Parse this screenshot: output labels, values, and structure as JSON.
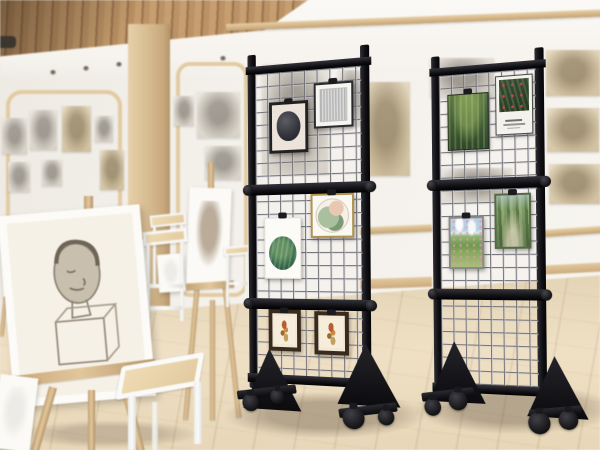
{
  "colors": {
    "stand_frame": "#17171b",
    "grid_wire": "#8f8f96",
    "wall": "#f4f1ec",
    "wood_trim": "#d8bd92",
    "ceiling_slats": "#c29a6b",
    "floor": "#e9dabd",
    "easel_wood": "#d9be94",
    "canvas_white": "#fbfaf6",
    "wheel_black": "#141416"
  },
  "stands": {
    "left": {
      "label": "rolling-grid-panel-display-stand",
      "sections": 3,
      "wheel_count": 4,
      "artworks": [
        {
          "name": "charcoal-circle-framed-print",
          "kind": "dark-circle",
          "x": 25,
          "y": 56,
          "w": 41,
          "h": 52,
          "bw": 3,
          "frame": "#232021",
          "mat": "#ece4da"
        },
        {
          "name": "gray-stripe-framed-print",
          "kind": "stripes",
          "x": 72,
          "y": 40,
          "w": 40,
          "h": 45,
          "bw": 2,
          "frame": "#2b2b2d",
          "mat": "#f6f5f2"
        },
        {
          "name": "succulent-art-print",
          "kind": "succulent",
          "x": 19,
          "y": 173,
          "w": 39,
          "h": 62,
          "bw": 1,
          "frame": "#e4e1da",
          "mat": "#fcfbf7"
        },
        {
          "name": "abstract-circle-gold-framed-print",
          "kind": "abstract-circle",
          "x": 68,
          "y": 150,
          "w": 44,
          "h": 44,
          "bw": 2,
          "frame": "#b3914e",
          "mat": "#faf8f3"
        },
        {
          "name": "botanical-bird-print-1",
          "kind": "bird",
          "x": 23,
          "y": 266,
          "w": 34,
          "h": 42,
          "bw": 4,
          "frame": "#392a1e",
          "mat": "#f2e8d4"
        },
        {
          "name": "botanical-bird-print-2",
          "kind": "bird",
          "x": 71,
          "y": 267,
          "w": 35,
          "h": 43,
          "bw": 4,
          "frame": "#392a1e",
          "mat": "#f2e8d4"
        }
      ]
    },
    "right": {
      "label": "rolling-grid-panel-display-stand",
      "sections": 3,
      "wheel_count": 4,
      "artworks": [
        {
          "name": "forest-painting",
          "kind": "forest",
          "x": 19,
          "y": 46,
          "w": 43,
          "h": 57,
          "bw": 1,
          "frame": "#26301f",
          "mat": "#44603a"
        },
        {
          "name": "botanical-poster",
          "kind": "poster",
          "x": 69,
          "y": 31,
          "w": 38,
          "h": 59,
          "bw": 1,
          "frame": "#4a4a48",
          "mat": "#f4f2ec"
        },
        {
          "name": "meadow-landscape-painting",
          "kind": "meadow",
          "x": 19,
          "y": 170,
          "w": 37,
          "h": 53,
          "bw": 2,
          "frame": "#8a8a86",
          "mat": "#bcd3e2"
        },
        {
          "name": "tree-path-painting",
          "kind": "trees",
          "x": 67,
          "y": 148,
          "w": 37,
          "h": 55,
          "bw": 2,
          "frame": "#55684a",
          "mat": "#7e9a64"
        }
      ]
    }
  },
  "wall_sketches": [
    {
      "x": 2,
      "y": 118,
      "w": 25,
      "h": 36,
      "tone": "gray"
    },
    {
      "x": 30,
      "y": 110,
      "w": 27,
      "h": 40,
      "tone": "gray"
    },
    {
      "x": 62,
      "y": 106,
      "w": 29,
      "h": 46,
      "tone": "sepia"
    },
    {
      "x": 95,
      "y": 116,
      "w": 18,
      "h": 26,
      "tone": "gray"
    },
    {
      "x": 8,
      "y": 162,
      "w": 22,
      "h": 30,
      "tone": "gray"
    },
    {
      "x": 42,
      "y": 160,
      "w": 20,
      "h": 26,
      "tone": "gray"
    },
    {
      "x": 100,
      "y": 150,
      "w": 24,
      "h": 40,
      "tone": "sepia"
    },
    {
      "x": 174,
      "y": 96,
      "w": 20,
      "h": 30,
      "tone": "gray"
    },
    {
      "x": 197,
      "y": 92,
      "w": 43,
      "h": 46,
      "tone": "gray"
    },
    {
      "x": 205,
      "y": 146,
      "w": 36,
      "h": 34,
      "tone": "gray"
    },
    {
      "x": 262,
      "y": 64,
      "w": 66,
      "h": 110,
      "tone": "gray"
    },
    {
      "x": 338,
      "y": 70,
      "w": 26,
      "h": 56,
      "tone": "gray"
    },
    {
      "x": 362,
      "y": 82,
      "w": 48,
      "h": 94,
      "tone": "sepia"
    },
    {
      "x": 430,
      "y": 58,
      "w": 64,
      "h": 40,
      "tone": "gray"
    },
    {
      "x": 440,
      "y": 168,
      "w": 72,
      "h": 34,
      "tone": "gray"
    },
    {
      "x": 546,
      "y": 50,
      "w": 54,
      "h": 46,
      "tone": "sepia"
    },
    {
      "x": 547,
      "y": 108,
      "w": 52,
      "h": 44,
      "tone": "sepia"
    },
    {
      "x": 549,
      "y": 164,
      "w": 51,
      "h": 40,
      "tone": "sepia"
    }
  ],
  "environment": {
    "ceiling_lights": [
      [
        50,
        70
      ],
      [
        83,
        66
      ],
      [
        116,
        62
      ],
      [
        220,
        56
      ]
    ],
    "easel_count": 6,
    "stool_count": 4
  }
}
